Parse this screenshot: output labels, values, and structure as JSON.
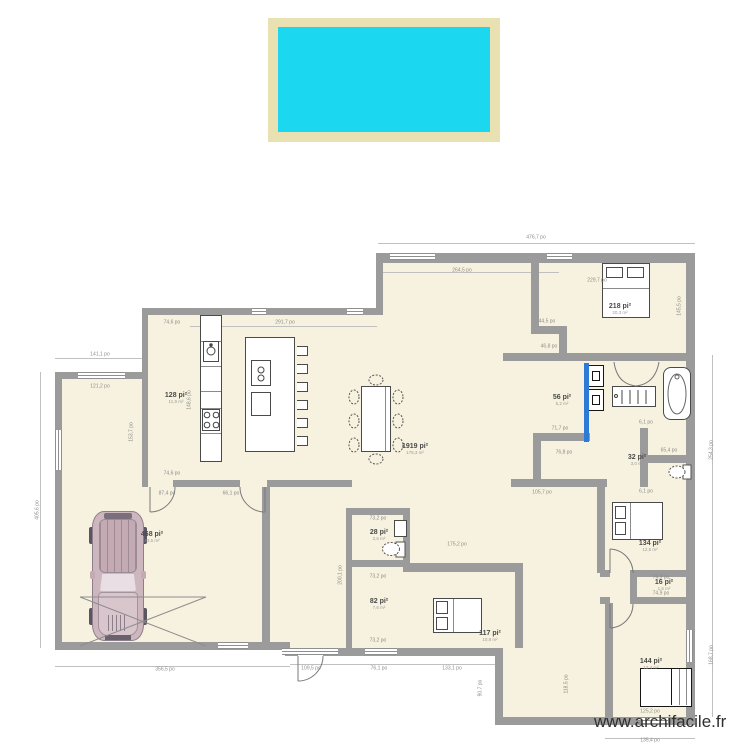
{
  "site": {
    "watermark": "www.archifacile.fr"
  },
  "units": {
    "length_unit": "po",
    "area_unit": "pi²"
  },
  "colors": {
    "pool_water": "#1bd7f0",
    "pool_deck": "#eae1b2",
    "wall": "#9b9b9b",
    "floor": "#f7f2df",
    "sliding_door_highlight": "#2e7bd6"
  },
  "furniture_items": [
    "car",
    "double-bed-top-right",
    "double-bed-south",
    "double-bed-mid-right",
    "wardrobe",
    "dining-table-8-chairs",
    "kitchen-island-6-stools",
    "kitchen-counter",
    "sink",
    "stove",
    "washer",
    "dryer",
    "shower",
    "bathtub",
    "vanity",
    "toilet-wc",
    "toilet-bath",
    "wc-sink"
  ],
  "rooms": [
    {
      "name": "bedroom-top-right",
      "area": "218 pi²",
      "sub": "20,3 m²",
      "x": 620,
      "y": 309
    },
    {
      "name": "kitchen",
      "area": "128 pi²",
      "sub": "11,9 m²",
      "x": 176,
      "y": 398
    },
    {
      "name": "living",
      "area": "1919 pi²",
      "sub": "178,3 m²",
      "x": 415,
      "y": 449
    },
    {
      "name": "garage",
      "area": "468 pi²",
      "sub": "43,5 m²",
      "x": 152,
      "y": 537
    },
    {
      "name": "wc",
      "area": "28 pi²",
      "sub": "2,6 m²",
      "x": 379,
      "y": 535
    },
    {
      "name": "storage",
      "area": "82 pi²",
      "sub": "7,6 m²",
      "x": 379,
      "y": 604
    },
    {
      "name": "bedroom-south",
      "area": "117 pi²",
      "sub": "10,9 m²",
      "x": 490,
      "y": 636
    },
    {
      "name": "bathroom",
      "area": "56 pi²",
      "sub": "5,2 m²",
      "x": 562,
      "y": 400
    },
    {
      "name": "wc-2",
      "area": "32 pi²",
      "sub": "3,0 m²",
      "x": 637,
      "y": 460
    },
    {
      "name": "bedroom-mid-right",
      "area": "134 pi²",
      "sub": "12,5 m²",
      "x": 650,
      "y": 546
    },
    {
      "name": "closet",
      "area": "16 pi²",
      "sub": "1,5 m²",
      "x": 664,
      "y": 585
    },
    {
      "name": "bedroom-south-east",
      "area": "144 pi²",
      "sub": "13,4 m²",
      "x": 651,
      "y": 664
    }
  ],
  "dimensions": [
    {
      "text": "476,7 po",
      "x": 536,
      "y": 238
    },
    {
      "text": "264,5 po",
      "x": 462,
      "y": 271
    },
    {
      "text": "291,7 po",
      "x": 285,
      "y": 323
    },
    {
      "text": "74,6 po",
      "x": 172,
      "y": 323
    },
    {
      "text": "229,7 po",
      "x": 597,
      "y": 281
    },
    {
      "text": "145,5 po",
      "x": 680,
      "y": 306,
      "vertical": true
    },
    {
      "text": "405,6 po",
      "x": 38,
      "y": 510,
      "vertical": true
    },
    {
      "text": "141,1 po",
      "x": 100,
      "y": 355
    },
    {
      "text": "121,2 po",
      "x": 100,
      "y": 387
    },
    {
      "text": "153,7 po",
      "x": 132,
      "y": 432,
      "vertical": true
    },
    {
      "text": "148,6 po",
      "x": 190,
      "y": 400,
      "vertical": true
    },
    {
      "text": "74,6 po",
      "x": 172,
      "y": 474
    },
    {
      "text": "87,4 po",
      "x": 167,
      "y": 494
    },
    {
      "text": "66,1 po",
      "x": 231,
      "y": 494
    },
    {
      "text": "356,5 po",
      "x": 165,
      "y": 670
    },
    {
      "text": "109,5 po",
      "x": 311,
      "y": 669
    },
    {
      "text": "76,1 po",
      "x": 379,
      "y": 669
    },
    {
      "text": "133,1 po",
      "x": 452,
      "y": 669
    },
    {
      "text": "90,7 po",
      "x": 481,
      "y": 688,
      "vertical": true
    },
    {
      "text": "118,5 po",
      "x": 567,
      "y": 684,
      "vertical": true
    },
    {
      "text": "135,4 po",
      "x": 650,
      "y": 741
    },
    {
      "text": "254,3 po",
      "x": 712,
      "y": 450,
      "vertical": true
    },
    {
      "text": "168,7 po",
      "x": 712,
      "y": 655,
      "vertical": true
    },
    {
      "text": "44,5 po",
      "x": 547,
      "y": 322
    },
    {
      "text": "46,8 po",
      "x": 549,
      "y": 347
    },
    {
      "text": "71,7 po",
      "x": 560,
      "y": 429
    },
    {
      "text": "76,8 po",
      "x": 564,
      "y": 453
    },
    {
      "text": "105,7 po",
      "x": 542,
      "y": 493
    },
    {
      "text": "200,1 po",
      "x": 341,
      "y": 575,
      "vertical": true
    },
    {
      "text": "73,2 po",
      "x": 378,
      "y": 519
    },
    {
      "text": "73,2 po",
      "x": 378,
      "y": 577
    },
    {
      "text": "73,2 po",
      "x": 378,
      "y": 641
    },
    {
      "text": "175,2 po",
      "x": 457,
      "y": 545
    },
    {
      "text": "74,9 po",
      "x": 661,
      "y": 578
    },
    {
      "text": "74,9 po",
      "x": 661,
      "y": 594
    },
    {
      "text": "65,4 po",
      "x": 669,
      "y": 451
    },
    {
      "text": "6,1 po",
      "x": 646,
      "y": 423
    },
    {
      "text": "6,1 po",
      "x": 646,
      "y": 492
    },
    {
      "text": "125,2 po",
      "x": 650,
      "y": 712
    }
  ]
}
